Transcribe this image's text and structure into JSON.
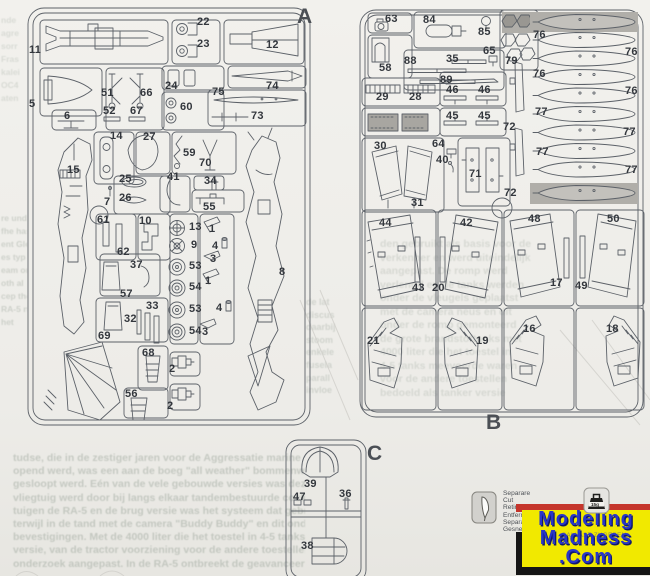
{
  "colors": {
    "paper": "#eeede9",
    "line": "#5c6168",
    "label": "#33373d",
    "gray_part": "#a8a6a1",
    "gray_bg": "#b0aea9",
    "logo_yellow": "#f1e900",
    "logo_blue": "#2936c8",
    "logo_red": "#c5352b",
    "logo_black": "#151515"
  },
  "sprues": {
    "a": {
      "labels": [
        {
          "t": "A",
          "x": 297,
          "y": 6,
          "big": true
        },
        {
          "t": "11",
          "x": 29,
          "y": 45
        },
        {
          "t": "22",
          "x": 197,
          "y": 17
        },
        {
          "t": "23",
          "x": 197,
          "y": 39
        },
        {
          "t": "12",
          "x": 266,
          "y": 40
        },
        {
          "t": "5",
          "x": 29,
          "y": 99
        },
        {
          "t": "51",
          "x": 101,
          "y": 88
        },
        {
          "t": "66",
          "x": 140,
          "y": 88
        },
        {
          "t": "52",
          "x": 103,
          "y": 106
        },
        {
          "t": "67",
          "x": 130,
          "y": 106
        },
        {
          "t": "6",
          "x": 64,
          "y": 111
        },
        {
          "t": "24",
          "x": 165,
          "y": 81
        },
        {
          "t": "60",
          "x": 180,
          "y": 102
        },
        {
          "t": "74",
          "x": 266,
          "y": 81
        },
        {
          "t": "75",
          "x": 212,
          "y": 87
        },
        {
          "t": "73",
          "x": 251,
          "y": 111
        },
        {
          "t": "14",
          "x": 110,
          "y": 131
        },
        {
          "t": "27",
          "x": 143,
          "y": 132
        },
        {
          "t": "15",
          "x": 67,
          "y": 165
        },
        {
          "t": "25",
          "x": 119,
          "y": 174
        },
        {
          "t": "26",
          "x": 119,
          "y": 193
        },
        {
          "t": "7",
          "x": 104,
          "y": 197
        },
        {
          "t": "59",
          "x": 183,
          "y": 148
        },
        {
          "t": "70",
          "x": 199,
          "y": 158
        },
        {
          "t": "41",
          "x": 167,
          "y": 172
        },
        {
          "t": "34",
          "x": 204,
          "y": 176
        },
        {
          "t": "55",
          "x": 203,
          "y": 202
        },
        {
          "t": "61",
          "x": 97,
          "y": 215
        },
        {
          "t": "10",
          "x": 139,
          "y": 216
        },
        {
          "t": "62",
          "x": 117,
          "y": 247
        },
        {
          "t": "13",
          "x": 189,
          "y": 222
        },
        {
          "t": "9",
          "x": 191,
          "y": 240
        },
        {
          "t": "53",
          "x": 189,
          "y": 261
        },
        {
          "t": "54",
          "x": 189,
          "y": 282
        },
        {
          "t": "53",
          "x": 189,
          "y": 304
        },
        {
          "t": "54",
          "x": 189,
          "y": 326
        },
        {
          "t": "1",
          "x": 209,
          "y": 224
        },
        {
          "t": "4",
          "x": 212,
          "y": 241
        },
        {
          "t": "3",
          "x": 210,
          "y": 254
        },
        {
          "t": "1",
          "x": 205,
          "y": 276
        },
        {
          "t": "4",
          "x": 216,
          "y": 303
        },
        {
          "t": "3",
          "x": 202,
          "y": 327
        },
        {
          "t": "37",
          "x": 130,
          "y": 260
        },
        {
          "t": "57",
          "x": 120,
          "y": 289
        },
        {
          "t": "33",
          "x": 146,
          "y": 301
        },
        {
          "t": "32",
          "x": 124,
          "y": 314
        },
        {
          "t": "69",
          "x": 98,
          "y": 331
        },
        {
          "t": "8",
          "x": 279,
          "y": 267
        },
        {
          "t": "68",
          "x": 142,
          "y": 348
        },
        {
          "t": "2",
          "x": 169,
          "y": 364
        },
        {
          "t": "56",
          "x": 125,
          "y": 389
        },
        {
          "t": "2",
          "x": 167,
          "y": 401
        }
      ]
    },
    "b": {
      "labels": [
        {
          "t": "B",
          "x": 486,
          "y": 412,
          "big": true
        },
        {
          "t": "63",
          "x": 385,
          "y": 14
        },
        {
          "t": "84",
          "x": 423,
          "y": 15
        },
        {
          "t": "85",
          "x": 478,
          "y": 27
        },
        {
          "t": "58",
          "x": 379,
          "y": 63
        },
        {
          "t": "88",
          "x": 404,
          "y": 56
        },
        {
          "t": "35",
          "x": 446,
          "y": 54
        },
        {
          "t": "65",
          "x": 483,
          "y": 46
        },
        {
          "t": "79",
          "x": 505,
          "y": 56
        },
        {
          "t": "89",
          "x": 440,
          "y": 75
        },
        {
          "t": "46",
          "x": 446,
          "y": 85
        },
        {
          "t": "46",
          "x": 478,
          "y": 85
        },
        {
          "t": "29",
          "x": 376,
          "y": 92
        },
        {
          "t": "28",
          "x": 409,
          "y": 92
        },
        {
          "t": "45",
          "x": 446,
          "y": 111
        },
        {
          "t": "45",
          "x": 478,
          "y": 111
        },
        {
          "t": "30",
          "x": 374,
          "y": 141
        },
        {
          "t": "64",
          "x": 432,
          "y": 139
        },
        {
          "t": "40",
          "x": 436,
          "y": 155
        },
        {
          "t": "71",
          "x": 469,
          "y": 169
        },
        {
          "t": "31",
          "x": 411,
          "y": 198
        },
        {
          "t": "72",
          "x": 503,
          "y": 122
        },
        {
          "t": "72",
          "x": 504,
          "y": 188
        },
        {
          "t": "76",
          "x": 533,
          "y": 30
        },
        {
          "t": "76",
          "x": 625,
          "y": 47
        },
        {
          "t": "76",
          "x": 533,
          "y": 69
        },
        {
          "t": "76",
          "x": 625,
          "y": 86
        },
        {
          "t": "77",
          "x": 535,
          "y": 107
        },
        {
          "t": "77",
          "x": 623,
          "y": 127
        },
        {
          "t": "77",
          "x": 536,
          "y": 147
        },
        {
          "t": "77",
          "x": 625,
          "y": 165
        },
        {
          "t": "44",
          "x": 379,
          "y": 218
        },
        {
          "t": "42",
          "x": 460,
          "y": 218
        },
        {
          "t": "48",
          "x": 528,
          "y": 214
        },
        {
          "t": "50",
          "x": 607,
          "y": 214
        },
        {
          "t": "43",
          "x": 412,
          "y": 283
        },
        {
          "t": "20",
          "x": 432,
          "y": 283
        },
        {
          "t": "17",
          "x": 550,
          "y": 278
        },
        {
          "t": "49",
          "x": 575,
          "y": 281
        },
        {
          "t": "21",
          "x": 367,
          "y": 336
        },
        {
          "t": "19",
          "x": 476,
          "y": 336
        },
        {
          "t": "16",
          "x": 523,
          "y": 324
        },
        {
          "t": "18",
          "x": 606,
          "y": 324
        }
      ]
    },
    "c": {
      "labels": [
        {
          "t": "C",
          "x": 367,
          "y": 443,
          "big": true
        },
        {
          "t": "39",
          "x": 304,
          "y": 479
        },
        {
          "t": "47",
          "x": 293,
          "y": 492
        },
        {
          "t": "36",
          "x": 339,
          "y": 489
        },
        {
          "t": "38",
          "x": 301,
          "y": 541
        }
      ]
    }
  },
  "cut_guide": {
    "icon": "knife-icon",
    "lines": [
      "Separare",
      "Cut",
      "Retirer",
      "Entfernen",
      "Separar",
      "Gesneden"
    ]
  },
  "ballast": {
    "icon": "weight-icon",
    "weight_text": "15g",
    "bleed_text": "BALLAST ZUGEBEN"
  },
  "logo": {
    "line1": "Modeling",
    "line2": "Madness",
    "line3": ".Com"
  },
  "bleedthrough": {
    "blocks": [
      {
        "x": 13,
        "y": 452,
        "w": 292,
        "fs": 10.5,
        "lh": 13.2,
        "op": 0.5,
        "lines": [
          "tudse, die in de zestiger jaren voor de Aggressatie marine",
          "opend werd, was een aan de boeg \"all weather\" bommenwerpers",
          "gesloopt werd. Eén van de vele gebouwde versies was deze",
          "vliegtuig werd door bij langs elkaar tandembestuurde cockpits. Het",
          "tuigen de RA-5 en de brug versie was het systeem dat gebruikt",
          "terwijl in de tand met de camera \"Buddy Buddy\" en dit onder",
          "bevestigingen. Met de 4000 liter die het toestel in 4-5 tanks",
          "versie, van de tractor voorziening voor de andere toestellen",
          "onderzoek aangepast. In de RA-5 ontbreekt de geavanceerde"
        ]
      },
      {
        "x": 380,
        "y": 238,
        "w": 260,
        "fs": 10.5,
        "lh": 13.5,
        "op": 0.3,
        "lines": [
          "den gebruikt als basis voor de",
          "verkenner en werd uiteindelijk",
          "aangepast. De romp werd",
          "verlengd en de tanks werden",
          "onder de vleugels geplaatst",
          "met de camera neus en dit",
          "onder de romp gemonteerd",
          "de grote brandstoftanks met",
          "4000 liter die het toestel in",
          "4-5 tanks meevoerde waren",
          "voor de andere toestellen",
          "bedoeld als tanker versie"
        ]
      },
      {
        "x": 306,
        "y": 296,
        "w": 52,
        "fs": 9,
        "lh": 12.6,
        "op": 0.38,
        "lines": [
          "de lat",
          "discus",
          "daarbij",
          "stoom",
          "enkele",
          "fusela",
          "parall",
          "invloe"
        ]
      },
      {
        "x": 1,
        "y": 212,
        "w": 26,
        "fs": 8.5,
        "lh": 13,
        "op": 0.42,
        "lines": [
          "re und",
          "fhe has",
          "ent Gle",
          "es typ",
          "eam org",
          "oth al",
          "cep the",
          "RA-5 no",
          "het"
        ]
      },
      {
        "x": 1,
        "y": 14,
        "w": 26,
        "fs": 8.5,
        "lh": 13,
        "op": 0.3,
        "lines": [
          "nde",
          "agre",
          "sorr",
          "Fras",
          "kalei",
          "OC4",
          "aten"
        ]
      }
    ]
  }
}
